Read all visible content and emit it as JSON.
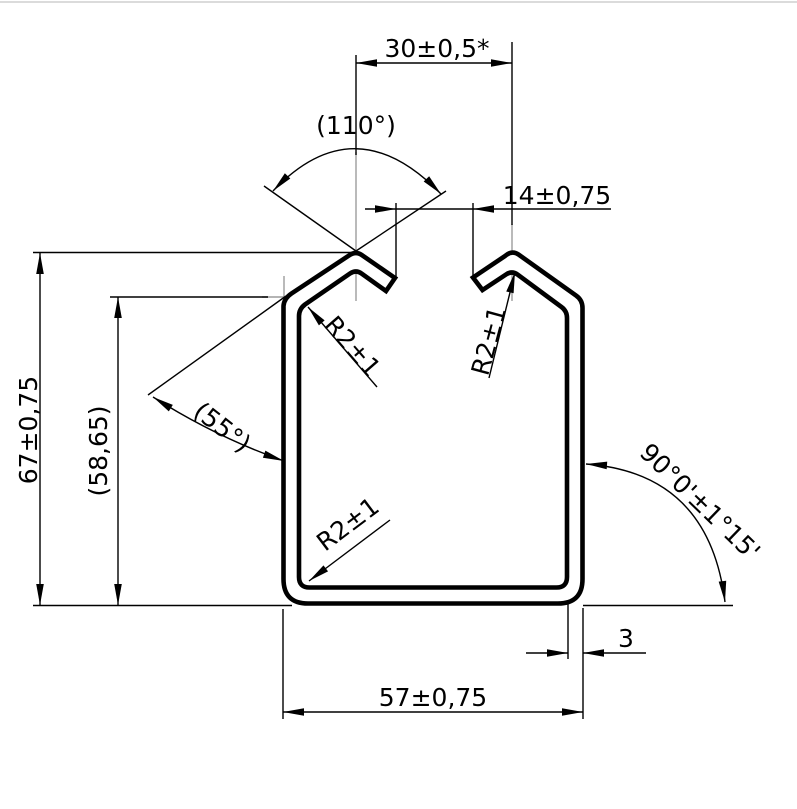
{
  "drawing": {
    "type": "technical-profile-cross-section",
    "colors": {
      "background": "#ffffff",
      "line": "#000000",
      "centerline": "#9c9c9c"
    },
    "labels": {
      "top_width": "30±0,5*",
      "top_angle": "(110°)",
      "slot_width": "14±0,75",
      "height": "67±0,75",
      "inner_height": "(58,65)",
      "bottom_width": "57±0,75",
      "thickness": "3",
      "corner_angle": "90°0'±1°15'",
      "side_angle": "(55°)",
      "radius_top_left": "R2±1",
      "radius_top_right": "R2±1",
      "radius_bottom_left": "R2±1"
    }
  }
}
